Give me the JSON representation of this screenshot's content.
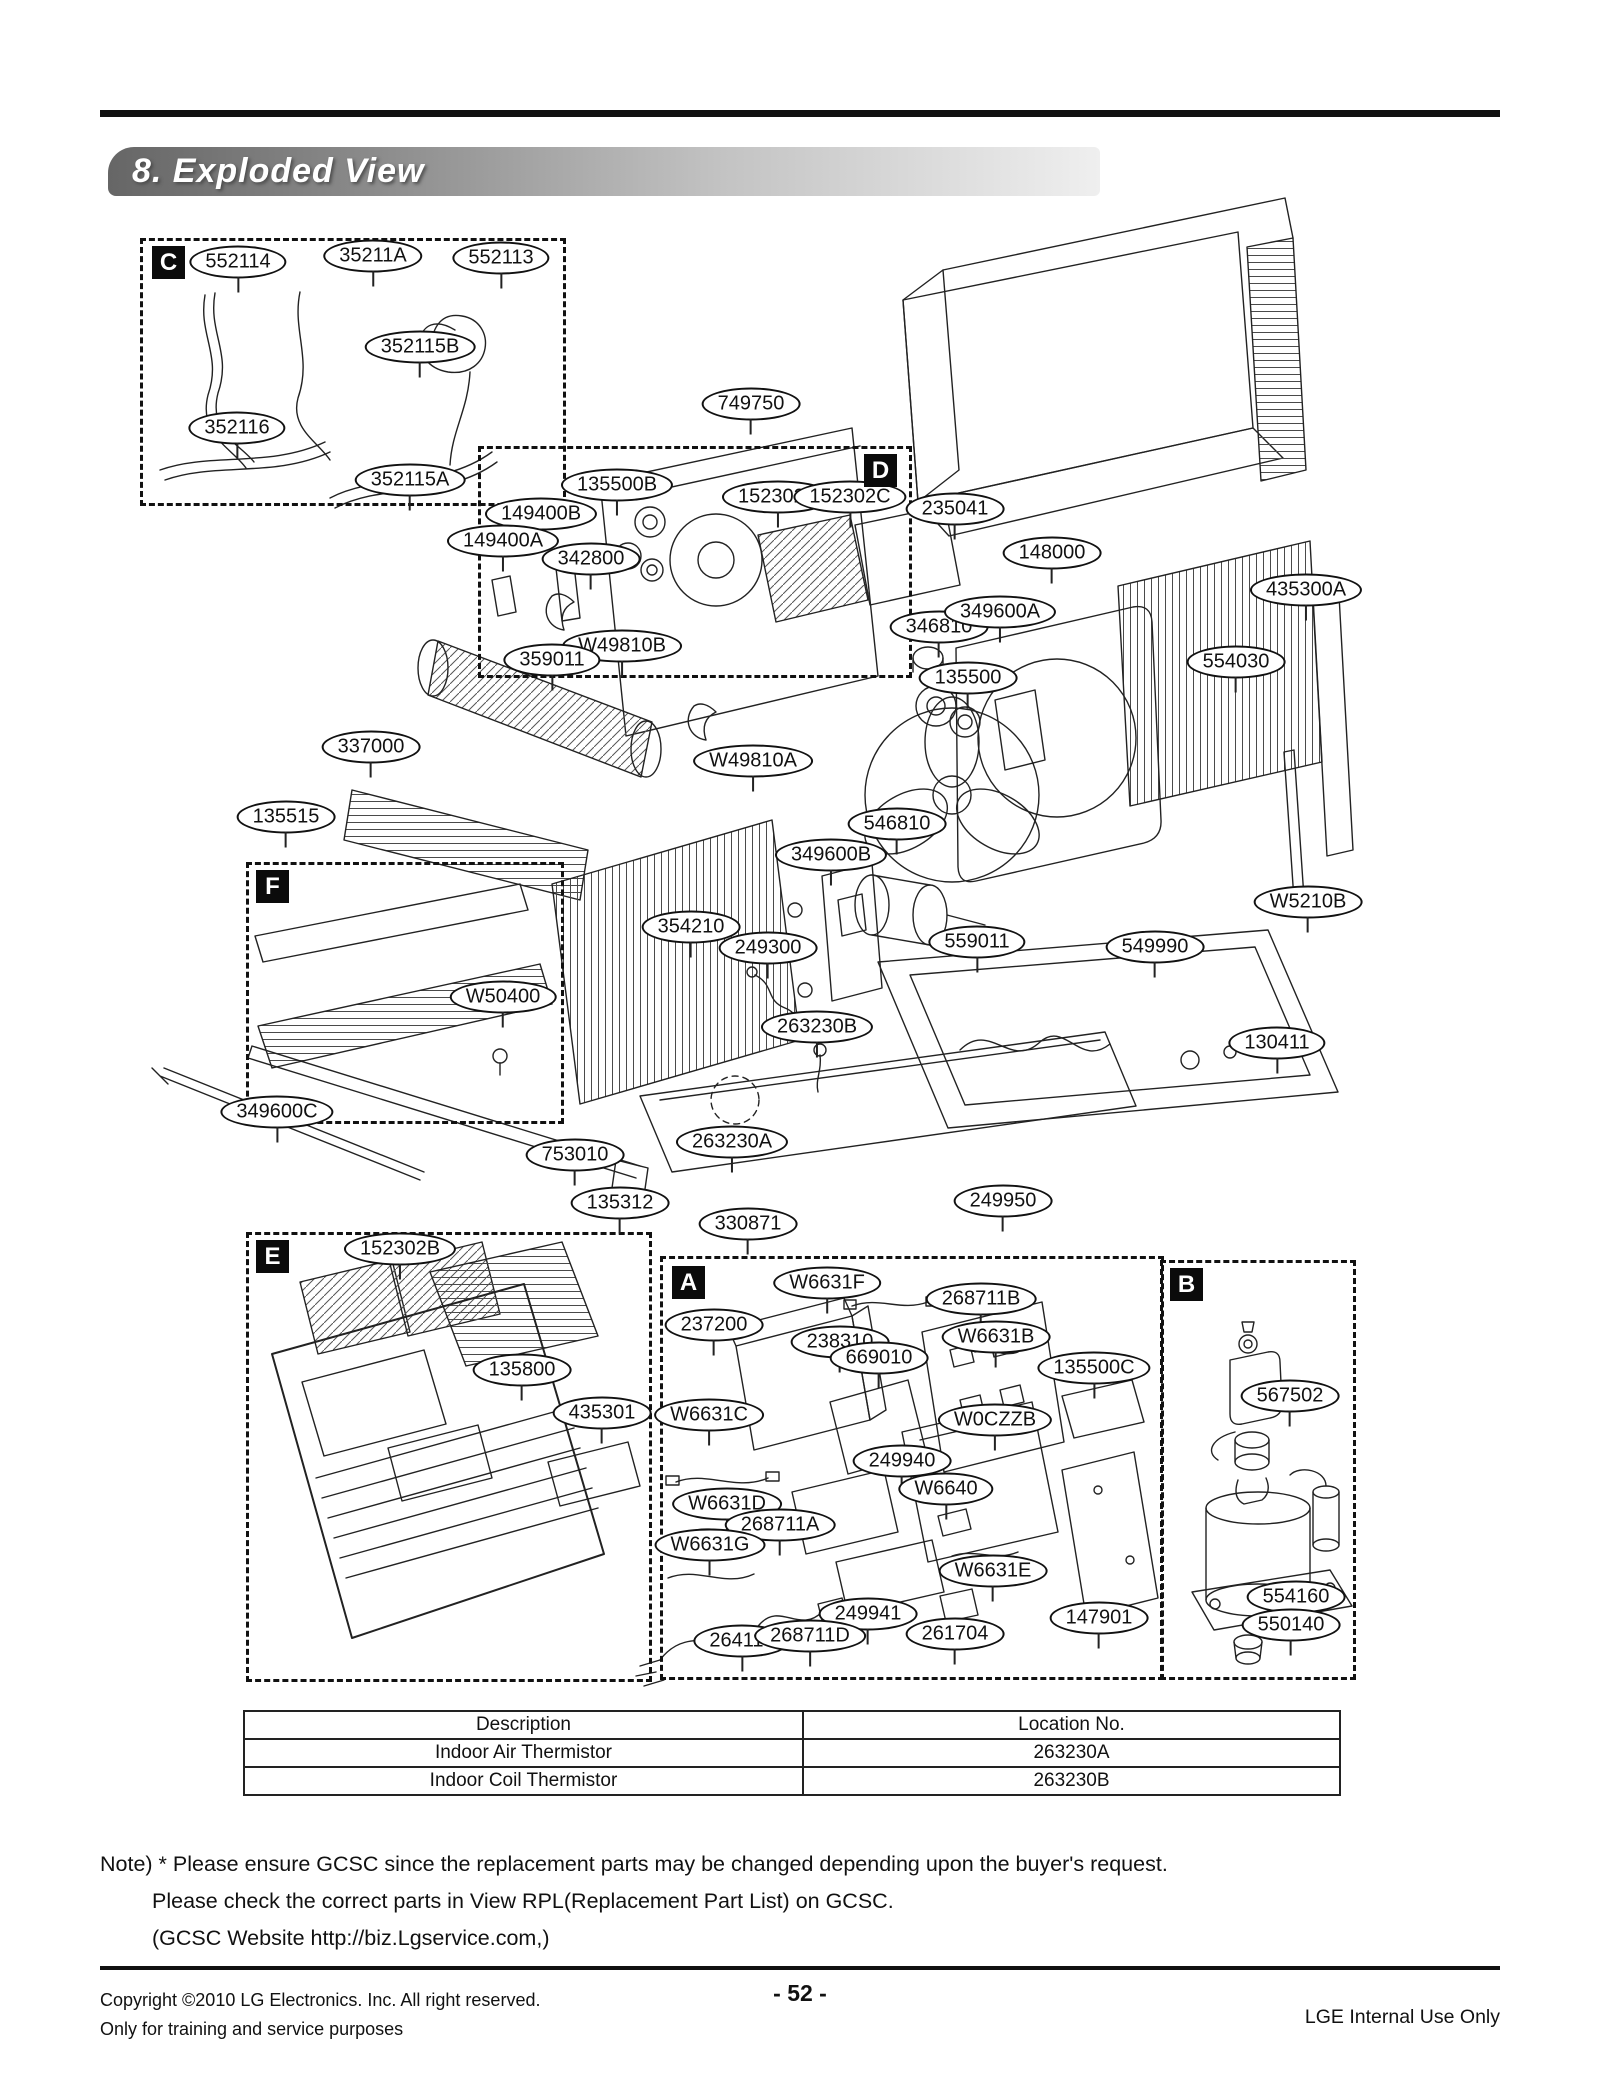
{
  "header": {
    "title": "8. Exploded View"
  },
  "diagram": {
    "sections": [
      {
        "letter": "C",
        "box": {
          "x": 140,
          "y": 238,
          "w": 420,
          "h": 262
        },
        "badge": {
          "x": 152,
          "y": 246
        }
      },
      {
        "letter": "D",
        "box": {
          "x": 478,
          "y": 446,
          "w": 428,
          "h": 226
        },
        "badge": {
          "x": 864,
          "y": 454
        }
      },
      {
        "letter": "F",
        "box": {
          "x": 246,
          "y": 862,
          "w": 312,
          "h": 256
        },
        "badge": {
          "x": 256,
          "y": 870
        }
      },
      {
        "letter": "E",
        "box": {
          "x": 246,
          "y": 1232,
          "w": 400,
          "h": 444
        },
        "badge": {
          "x": 256,
          "y": 1240
        }
      },
      {
        "letter": "A",
        "box": {
          "x": 660,
          "y": 1256,
          "w": 498,
          "h": 418
        },
        "badge": {
          "x": 672,
          "y": 1266
        }
      },
      {
        "letter": "B",
        "box": {
          "x": 1160,
          "y": 1260,
          "w": 190,
          "h": 414
        },
        "badge": {
          "x": 1170,
          "y": 1268
        }
      }
    ],
    "part_labels": [
      {
        "text": "552114",
        "x": 238,
        "y": 262
      },
      {
        "text": "35211A",
        "x": 373,
        "y": 256
      },
      {
        "text": "552113",
        "x": 501,
        "y": 258
      },
      {
        "text": "352115B",
        "x": 420,
        "y": 347
      },
      {
        "text": "352116",
        "x": 237,
        "y": 428
      },
      {
        "text": "352115A",
        "x": 410,
        "y": 480
      },
      {
        "text": "749750",
        "x": 751,
        "y": 404
      },
      {
        "text": "135500B",
        "x": 617,
        "y": 485
      },
      {
        "text": "149400B",
        "x": 541,
        "y": 514
      },
      {
        "text": "149400A",
        "x": 503,
        "y": 541
      },
      {
        "text": "342800",
        "x": 591,
        "y": 559
      },
      {
        "text": "152302A",
        "x": 778,
        "y": 497
      },
      {
        "text": "152302C",
        "x": 850,
        "y": 497
      },
      {
        "text": "235041",
        "x": 955,
        "y": 509
      },
      {
        "text": "148000",
        "x": 1052,
        "y": 553
      },
      {
        "text": "346810",
        "x": 939,
        "y": 627
      },
      {
        "text": "349600A",
        "x": 1000,
        "y": 612
      },
      {
        "text": "435300A",
        "x": 1306,
        "y": 590
      },
      {
        "text": "554030",
        "x": 1236,
        "y": 662
      },
      {
        "text": "W49810B",
        "x": 622,
        "y": 646
      },
      {
        "text": "359011",
        "x": 552,
        "y": 660
      },
      {
        "text": "135500",
        "x": 968,
        "y": 678
      },
      {
        "text": "W49810A",
        "x": 753,
        "y": 761
      },
      {
        "text": "337000",
        "x": 371,
        "y": 747
      },
      {
        "text": "135515",
        "x": 286,
        "y": 817
      },
      {
        "text": "546810",
        "x": 897,
        "y": 824
      },
      {
        "text": "349600B",
        "x": 831,
        "y": 855
      },
      {
        "text": "W5210B",
        "x": 1308,
        "y": 902
      },
      {
        "text": "354210",
        "x": 691,
        "y": 927
      },
      {
        "text": "249300",
        "x": 768,
        "y": 948
      },
      {
        "text": "559011",
        "x": 977,
        "y": 942
      },
      {
        "text": "549990",
        "x": 1155,
        "y": 947
      },
      {
        "text": "W50400",
        "x": 503,
        "y": 997
      },
      {
        "text": "263230B",
        "x": 817,
        "y": 1027
      },
      {
        "text": "130411",
        "x": 1277,
        "y": 1043
      },
      {
        "text": "349600C",
        "x": 277,
        "y": 1112
      },
      {
        "text": "753010",
        "x": 575,
        "y": 1155
      },
      {
        "text": "263230A",
        "x": 732,
        "y": 1142
      },
      {
        "text": "135312",
        "x": 620,
        "y": 1203
      },
      {
        "text": "330871",
        "x": 748,
        "y": 1224
      },
      {
        "text": "249950",
        "x": 1003,
        "y": 1201
      },
      {
        "text": "152302B",
        "x": 400,
        "y": 1249
      },
      {
        "text": "135800",
        "x": 522,
        "y": 1370
      },
      {
        "text": "435301",
        "x": 602,
        "y": 1413
      },
      {
        "text": "W6631F",
        "x": 827,
        "y": 1283
      },
      {
        "text": "268711B",
        "x": 981,
        "y": 1299
      },
      {
        "text": "237200",
        "x": 714,
        "y": 1325
      },
      {
        "text": "238310",
        "x": 840,
        "y": 1342
      },
      {
        "text": "669010",
        "x": 879,
        "y": 1358
      },
      {
        "text": "W6631B",
        "x": 996,
        "y": 1337
      },
      {
        "text": "135500C",
        "x": 1094,
        "y": 1368
      },
      {
        "text": "W6631C",
        "x": 709,
        "y": 1415
      },
      {
        "text": "W0CZZB",
        "x": 995,
        "y": 1420
      },
      {
        "text": "249940",
        "x": 902,
        "y": 1461
      },
      {
        "text": "W6640",
        "x": 946,
        "y": 1489
      },
      {
        "text": "W6631D",
        "x": 727,
        "y": 1504
      },
      {
        "text": "268711A",
        "x": 780,
        "y": 1525
      },
      {
        "text": "W6631G",
        "x": 710,
        "y": 1545
      },
      {
        "text": "W6631E",
        "x": 993,
        "y": 1571
      },
      {
        "text": "249941",
        "x": 868,
        "y": 1614
      },
      {
        "text": "264110",
        "x": 742,
        "y": 1641
      },
      {
        "text": "268711D",
        "x": 810,
        "y": 1636
      },
      {
        "text": "261704",
        "x": 955,
        "y": 1634
      },
      {
        "text": "147901",
        "x": 1099,
        "y": 1618
      },
      {
        "text": "567502",
        "x": 1290,
        "y": 1396
      },
      {
        "text": "554160",
        "x": 1296,
        "y": 1597
      },
      {
        "text": "550140",
        "x": 1291,
        "y": 1625
      }
    ]
  },
  "table": {
    "headers": [
      "Description",
      "Location No."
    ],
    "rows": [
      [
        "Indoor Air Thermistor",
        "263230A"
      ],
      [
        "Indoor Coil Thermistor",
        "263230B"
      ]
    ]
  },
  "note": {
    "lines": [
      "Note) * Please ensure GCSC since the replacement parts may be changed depending upon the buyer's request.",
      "Please check  the correct parts in View RPL(Replacement Part List) on GCSC.",
      "(GCSC Website  http://biz.Lgservice.com,)"
    ]
  },
  "footer": {
    "copyright_line1": "Copyright ©2010 LG Electronics. Inc. All right reserved.",
    "copyright_line2": "Only for training and service purposes",
    "page_number": "- 52 -",
    "right_text": "LGE Internal Use Only"
  }
}
